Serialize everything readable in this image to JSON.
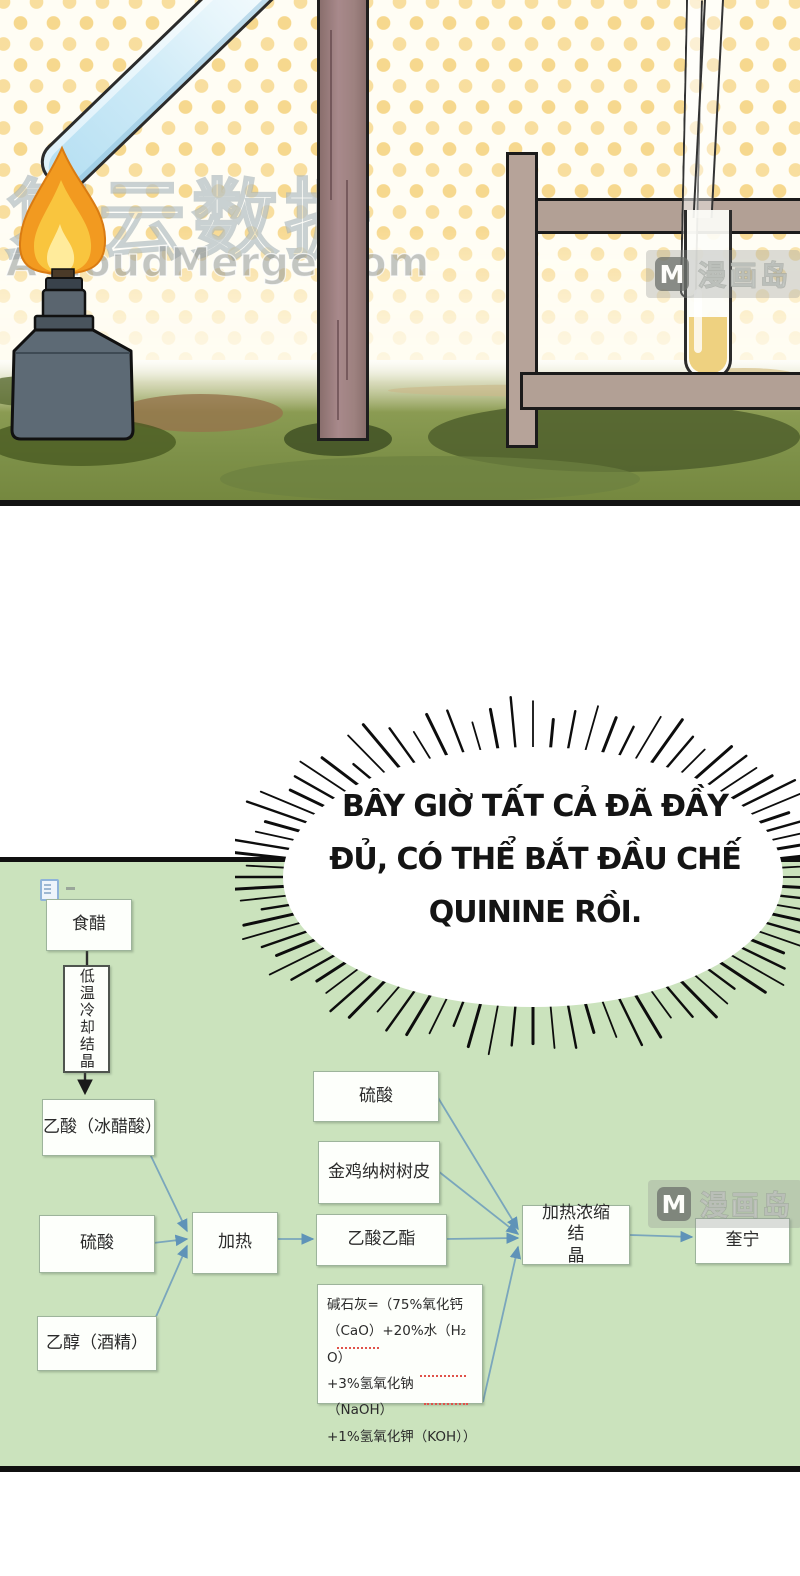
{
  "watermarks": {
    "site_cn": "复云数据",
    "site_en": "ACloudMerge.com",
    "manhuadao": {
      "badge": "M",
      "label": "漫画岛"
    }
  },
  "speech_bubble": {
    "line1": "BÂY GIỜ TẤT CẢ ĐÃ ĐẦY",
    "line2": "ĐỦ, CÓ THỂ BẮT ĐẦU CHẾ",
    "line3": "QUININE RỒI."
  },
  "flowchart": {
    "boxes": [
      {
        "id": "vinegar",
        "label": "食醋"
      },
      {
        "id": "low-temp-cooling-crystallize",
        "label": "低温冷却结晶"
      },
      {
        "id": "acetic-acid",
        "label": "乙酸（冰醋酸）"
      },
      {
        "id": "sulfuric-acid-1",
        "label": "硫酸"
      },
      {
        "id": "ethanol",
        "label": "乙醇（酒精）"
      },
      {
        "id": "heat",
        "label": "加热"
      },
      {
        "id": "sulfuric-acid-2",
        "label": "硫酸"
      },
      {
        "id": "cinchona-bark",
        "label": "金鸡纳树树皮"
      },
      {
        "id": "ethyl-acetate",
        "label": "乙酸乙酯"
      },
      {
        "id": "soda-lime",
        "label": "碱石灰=（75%氧化钙\n（CaO）+20%水（H₂ O）\n+3%氢氧化钠（NaOH）\n+1%氢氧化钾（KOH））"
      },
      {
        "id": "heat-concentrate-crystallize",
        "label": "加热浓缩结\n晶"
      },
      {
        "id": "quinine",
        "label": "奎宁"
      }
    ]
  },
  "colors": {
    "panel_green": "#cbe3bd",
    "arrow_blue": "#7aa6bc",
    "dot_yellow": "#f6d689",
    "grass": "#7d9048",
    "flame_orange": "#f29a20",
    "wood_post": "#a8898b",
    "fence_tan": "#b2a095",
    "tube_liquid_yellow": "#eed180",
    "tube_liquid_blue": "#cdeaf7"
  }
}
